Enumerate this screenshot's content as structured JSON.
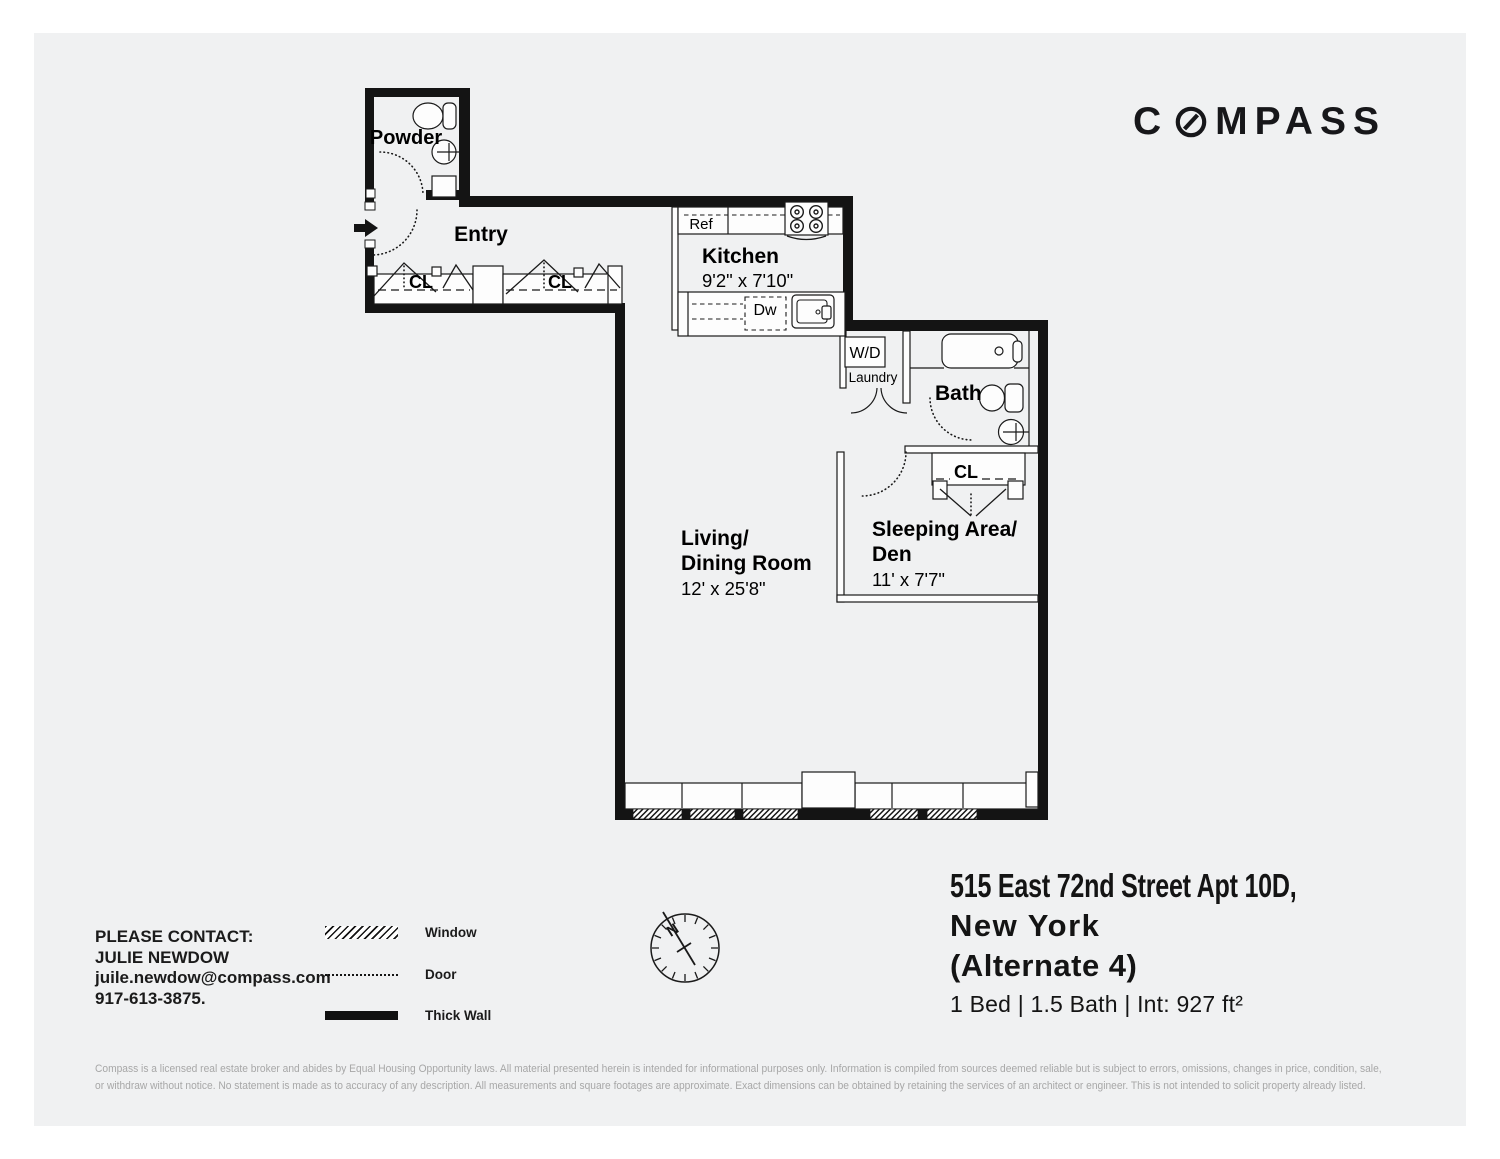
{
  "brand": {
    "part1": "C",
    "part2": "MPASS"
  },
  "listing": {
    "address_line1": "515 East 72nd Street Apt 10D,",
    "address_line2": "New York",
    "address_line3": "(Alternate 4)",
    "specs": "1 Bed | 1.5 Bath | Int: 927 ft²"
  },
  "contact": {
    "heading": "PLEASE CONTACT:",
    "name": "JULIE NEWDOW",
    "email": "juile.newdow@compass.com",
    "phone": "917-613-3875."
  },
  "legend": {
    "window": "Window",
    "door": "Door",
    "thick_wall": "Thick Wall"
  },
  "floorplan": {
    "powder": "Powder",
    "entry": "Entry",
    "kitchen_name": "Kitchen",
    "kitchen_dims": "9'2\" x 7'10\"",
    "ref": "Ref",
    "dw": "Dw",
    "wd": "W/D",
    "laundry": "Laundry",
    "bath": "Bath",
    "closet": "CL",
    "living_name1": "Living/",
    "living_name2": "Dining Room",
    "living_dims": "12' x 25'8\"",
    "sleeping_name1": "Sleeping Area/",
    "sleeping_name2": "Den",
    "sleeping_dims": "11' x 7'7\"",
    "north": "N"
  },
  "disclaimer": {
    "line1": "Compass is a licensed real estate broker and abides by Equal Housing Opportunity laws. All material presented herein is intended for informational purposes only. Information is compiled from sources deemed reliable but is subject to errors, omissions, changes in price, condition, sale,",
    "line2": "or withdraw without notice. No statement is made as to accuracy of any description. All measurements and square footages are approximate. Exact dimensions can be obtained by retaining the services of an architect or engineer. This is not intended to solicit property already listed."
  }
}
